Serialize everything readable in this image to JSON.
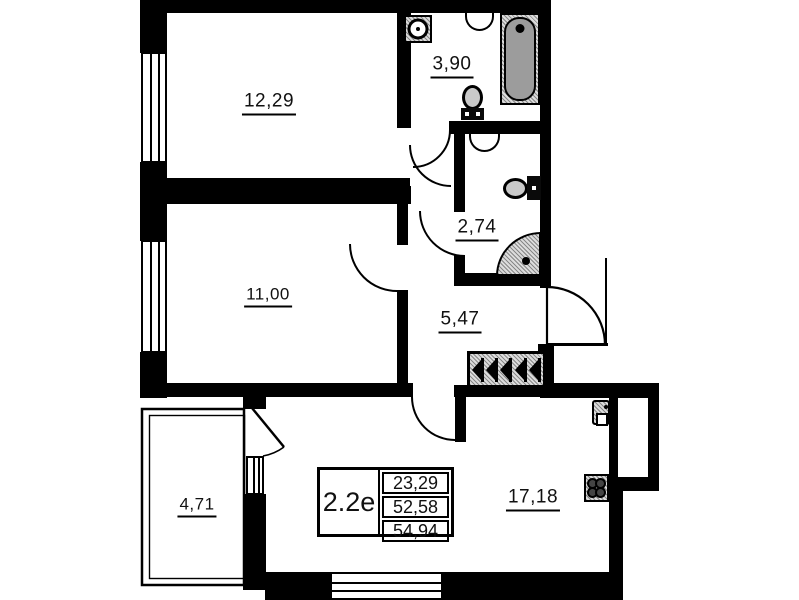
{
  "plan": {
    "unit": {
      "label": "2.2е",
      "values": [
        "23,29",
        "52,58",
        "54,94"
      ]
    },
    "rooms": {
      "bedroom1": {
        "area": "12,29"
      },
      "bedroom2": {
        "area": "11,00"
      },
      "bathroom": {
        "area": "3,90"
      },
      "wc": {
        "area": "2,74"
      },
      "hall": {
        "area": "5,47"
      },
      "balcony": {
        "area": "4,71"
      },
      "kitchen_living": {
        "area": "17,18"
      }
    },
    "colors": {
      "wall": "#000000",
      "paper": "#ffffff",
      "fixture_gray": "#9c9c9c"
    },
    "icons": [
      "washing-machine-icon",
      "sink-icon",
      "bathtub-icon",
      "toilet-icon",
      "shower-icon",
      "wardrobe-icon",
      "kitchen-sink-icon",
      "stove-icon",
      "window-icon",
      "door-arc-icon"
    ]
  }
}
